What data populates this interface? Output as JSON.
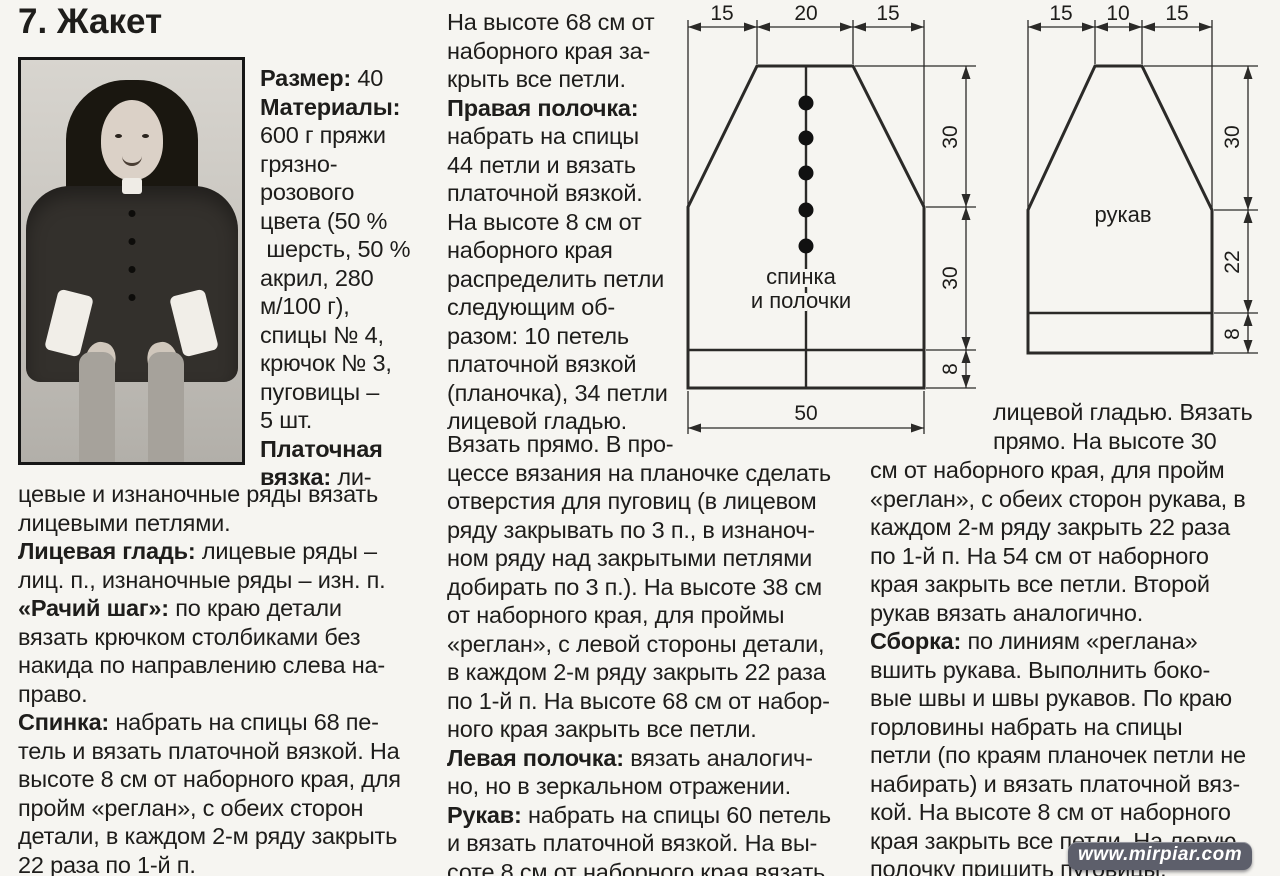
{
  "page": {
    "title": "7. Жакет",
    "watermark": "www.mirpiar.com"
  },
  "sidebar_materials": {
    "paras": [
      {
        "label": "Размер:",
        "text": " 40"
      },
      {
        "label": "Материалы:",
        "text": "\n600 г пряжи\nгрязно-\nрозового\nцвета (50 %\n шерсть, 50 %\nакрил, 280\nм/100 г),\nспицы № 4,\nкрючок № 3,\nпуговицы –\n5 шт."
      },
      {
        "label": "Платочная\nвязка:",
        "text": " ли-"
      }
    ]
  },
  "left_column": {
    "paras": [
      {
        "label": "",
        "text": "цевые и изнаночные ряды вязать\nлицевыми петлями."
      },
      {
        "label": "Лицевая гладь:",
        "text": " лицевые ряды –\nлиц. п., изнаночные ряды – изн. п."
      },
      {
        "label": "«Рачий шаг»:",
        "text": " по краю детали\nвязать крючком столбиками без\nнакида по направлению слева на-\nправо."
      },
      {
        "label": "Спинка:",
        "text": " набрать на спицы 68 пе-\nтель и вязать платочной вязкой. На\nвысоте 8 см от наборного края, для\nпройм «реглан», с обеих сторон\nдетали, в каждом 2-м ряду закрыть\n22 раза по 1-й п."
      }
    ]
  },
  "middle_column_top": {
    "paras": [
      {
        "label": "",
        "text": "На высоте 68 см от\nнаборного края за-\nкрыть все петли."
      },
      {
        "label": "Правая полочка:",
        "text": "\nнабрать на спицы\n44 петли и вязать\nплаточной вязкой.\nНа высоте 8 см от\nнаборного края\nраспределить петли\nследующим об-\nразом: 10 петель\nплаточной вязкой\n(планочка), 34 петли\nлицевой гладью."
      }
    ]
  },
  "middle_column_bottom": {
    "paras": [
      {
        "label": "",
        "text": "Вязать прямо. В про-\nцессе вязания на планочке сделать\nотверстия для пуговиц (в лицевом\nряду закрывать по 3 п., в изнаноч-\nном ряду над закрытыми петлями\nдобирать по 3 п.). На высоте 38 см\nот наборного края, для проймы\n«реглан», с левой стороны детали,\nв каждом 2-м ряду закрыть 22 раза\nпо 1-й п. На высоте 68 см от набор-\nного края закрыть все петли."
      },
      {
        "label": "Левая полочка:",
        "text": " вязать аналогич-\nно, но в зеркальном отражении."
      },
      {
        "label": "Рукав:",
        "text": " набрать на спицы 60 петель\nи вязать платочной вязкой. На вы-\nсоте 8 см от наборного края вязать"
      }
    ]
  },
  "right_column_top": {
    "paras": [
      {
        "label": "",
        "text": "лицевой гладью. Вязать\nпрямо. На высоте 30"
      }
    ]
  },
  "right_column_bottom": {
    "paras": [
      {
        "label": "",
        "text": "см от наборного края, для пройм\n«реглан», с обеих сторон рукава, в\nкаждом 2-м ряду закрыть 22 раза\nпо 1-й п. На 54 см от наборного\nкрая закрыть все петли. Второй\nрукав вязать аналогично."
      },
      {
        "label": "Сборка:",
        "text": " по линиям «реглана»\nвшить рукава. Выполнить боко-\nвые швы и швы рукавов. По краю\nгорловины набрать на спицы\nпетли (по краям планочек петли не\nнабирать) и вязать платочной вяз-\nкой. На высоте 8 см от наборного\nкрая закрыть все петли. На левую\nполочку пришить пуговицы."
      }
    ]
  },
  "diagram_back": {
    "top_dims": [
      "15",
      "20",
      "15"
    ],
    "side_dims": [
      "30",
      "30",
      "8"
    ],
    "bottom_dim": "50",
    "label_line1": "спинка",
    "label_line2": "и полочки",
    "buttons_count": 5
  },
  "diagram_sleeve": {
    "top_dims": [
      "15",
      "10",
      "15"
    ],
    "side_dims": [
      "30",
      "22",
      "8"
    ],
    "label": "рукав"
  },
  "colors": {
    "ink": "#1e1d1b",
    "paper": "#f6f5f1",
    "watermark_bg": "#5d5f6b"
  }
}
